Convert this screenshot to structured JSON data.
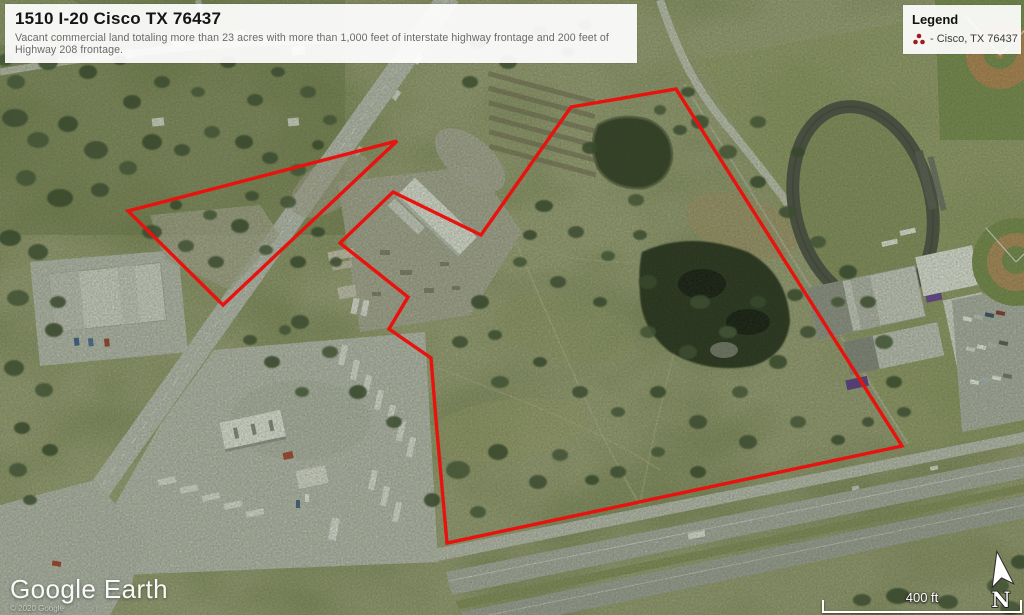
{
  "banner": {
    "title": "1510 I-20 Cisco TX 76437",
    "description": "Vacant commercial land totaling more than 23 acres with more than 1,000 feet of interstate highway frontage and 200 feet of Highway 208 frontage."
  },
  "legend": {
    "title": "Legend",
    "item": {
      "icon": "red-cluster-place-marker",
      "color": "#9e1c20",
      "label": "- Cisco, TX 76437"
    }
  },
  "attribution": {
    "brand": "Google Earth",
    "copyright": "© 2020 Google"
  },
  "scale_bar": {
    "label": "400 ft"
  },
  "compass": {
    "label": "N"
  },
  "boundary": {
    "color": "#e8120e",
    "parcel_main_points": "571,107 676,89 902,446 447,543 436,420 431,358 389,329 408,297 340,243 393,192 481,235",
    "parcel_west_points": "397,141 128,211 223,305"
  }
}
